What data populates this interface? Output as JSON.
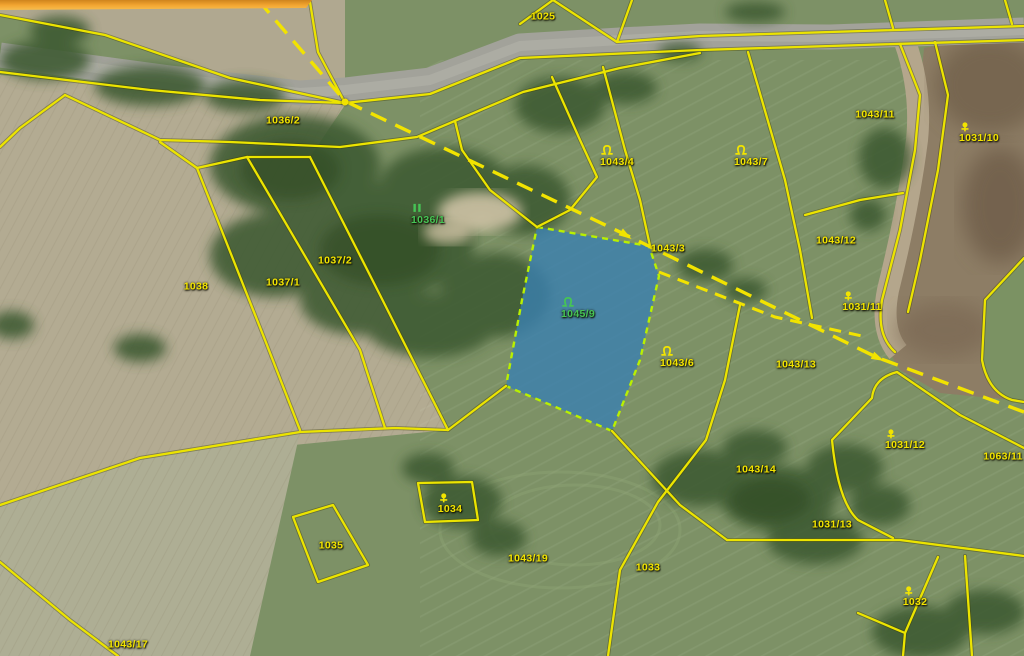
{
  "map": {
    "type": "cadastral-parcel-map-over-orthophoto",
    "colors": {
      "label_yellow": "#f2e400",
      "label_green": "#46c455",
      "boundary_yellow": "#ece400",
      "dashed_yellow": "#f2e300",
      "highlight_fill": "#3a7fb0",
      "highlight_border": "#b9f000",
      "orange_bar": "#f2a430"
    },
    "highlighted_parcel": {
      "number": "1045/9",
      "label_color": "green",
      "symbol": "meadow"
    },
    "parcels": [
      {
        "label": "1025",
        "x": 543,
        "y": 18,
        "color": "yellow"
      },
      {
        "label": "1036/2",
        "x": 283,
        "y": 122,
        "color": "yellow"
      },
      {
        "label": "1036/1",
        "x": 428,
        "y": 216,
        "color": "green",
        "symbol": "forest"
      },
      {
        "label": "1043/4",
        "x": 617,
        "y": 158,
        "color": "yellow",
        "symbol": "meadow"
      },
      {
        "label": "1043/7",
        "x": 751,
        "y": 158,
        "color": "yellow",
        "symbol": "meadow"
      },
      {
        "label": "1043/11",
        "x": 875,
        "y": 116,
        "color": "yellow"
      },
      {
        "label": "1031/10",
        "x": 979,
        "y": 134,
        "color": "yellow",
        "symbol": "orchard"
      },
      {
        "label": "1037/2",
        "x": 335,
        "y": 262,
        "color": "yellow"
      },
      {
        "label": "1037/1",
        "x": 283,
        "y": 284,
        "color": "yellow"
      },
      {
        "label": "1038",
        "x": 196,
        "y": 288,
        "color": "yellow"
      },
      {
        "label": "1043/3",
        "x": 668,
        "y": 250,
        "color": "yellow"
      },
      {
        "label": "1045/9",
        "x": 578,
        "y": 310,
        "color": "green",
        "symbol": "meadow"
      },
      {
        "label": "1043/6",
        "x": 677,
        "y": 359,
        "color": "yellow",
        "symbol": "meadow"
      },
      {
        "label": "1043/12",
        "x": 836,
        "y": 242,
        "color": "yellow"
      },
      {
        "label": "1031/11",
        "x": 862,
        "y": 303,
        "color": "yellow",
        "symbol": "orchard"
      },
      {
        "label": "1043/13",
        "x": 796,
        "y": 366,
        "color": "yellow"
      },
      {
        "label": "1031/12",
        "x": 905,
        "y": 441,
        "color": "yellow",
        "symbol": "orchard"
      },
      {
        "label": "1063/11",
        "x": 1003,
        "y": 458,
        "color": "yellow"
      },
      {
        "label": "1043/14",
        "x": 756,
        "y": 471,
        "color": "yellow"
      },
      {
        "label": "1031/13",
        "x": 832,
        "y": 526,
        "color": "yellow"
      },
      {
        "label": "1034",
        "x": 450,
        "y": 505,
        "color": "yellow",
        "symbol": "orchard"
      },
      {
        "label": "1035",
        "x": 331,
        "y": 547,
        "color": "yellow"
      },
      {
        "label": "1043/19",
        "x": 528,
        "y": 560,
        "color": "yellow"
      },
      {
        "label": "1033",
        "x": 648,
        "y": 569,
        "color": "yellow"
      },
      {
        "label": "1032",
        "x": 915,
        "y": 598,
        "color": "yellow",
        "symbol": "orchard"
      },
      {
        "label": "1043/17",
        "x": 128,
        "y": 646,
        "color": "yellow"
      }
    ],
    "markers": [
      {
        "type": "dot",
        "x": 345,
        "y": 102
      },
      {
        "type": "arrow",
        "x": 624,
        "y": 234,
        "angle": 33
      },
      {
        "type": "arrow",
        "x": 876,
        "y": 357,
        "angle": 26
      }
    ]
  }
}
